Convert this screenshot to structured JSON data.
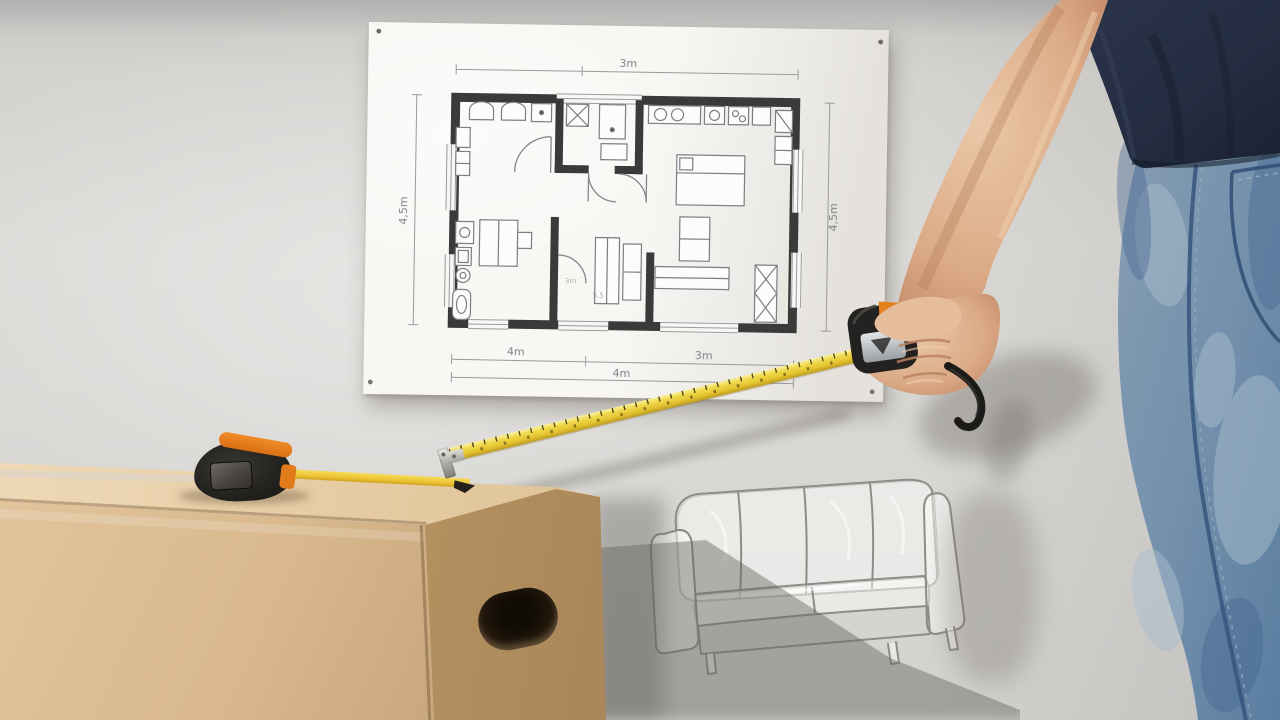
{
  "floor_plan": {
    "dim_top": "3m",
    "dim_left": "4,5m",
    "dim_right": "4,5m",
    "dim_bottom_left": "4m",
    "dim_bottom_right": "3m",
    "dim_bottom_overall": "4m",
    "corridor_label_1": "3m",
    "corridor_label_2": "5,5"
  },
  "colors": {
    "wall_grey": "#d9d8d5",
    "paper_white": "#f8f7f4",
    "plan_wall_dark": "#3a3a3a",
    "plan_line_grey": "#85858c",
    "box_top": "#e6cba4",
    "box_front": "#d9b88d",
    "box_side": "#b5925f",
    "tape_yellow": "#efd84a",
    "tape_body_black": "#252320",
    "tape_accent_orange": "#e5801f",
    "tshirt_navy": "#242d41",
    "jeans_blue": "#7390ac",
    "skin_tone": "#dcab88",
    "pencil_sketch": "#8e8c88"
  }
}
